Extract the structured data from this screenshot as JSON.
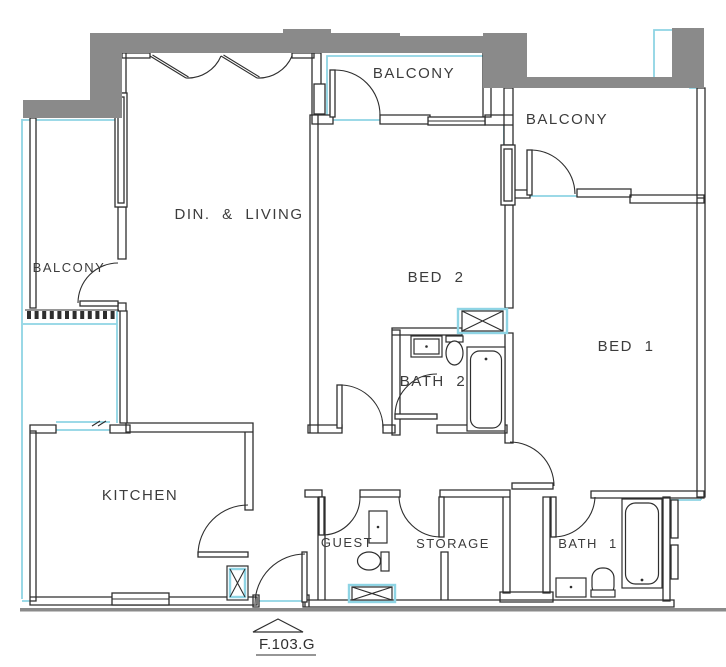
{
  "plan": {
    "unit_label": "F.103.G",
    "rooms": {
      "dining_living": "DIN. & LIVING",
      "balcony_left": "BALCONY",
      "balcony_top": "BALCONY",
      "balcony_right": "BALCONY",
      "bed_2": "BED 2",
      "bed_1": "BED 1",
      "bath_2": "BATH 2",
      "kitchen": "KITCHEN",
      "guest": "GUEST",
      "storage": "STORAGE",
      "bath_1": "BATH 1"
    },
    "colors": {
      "wall_gray": "#8a8a8a",
      "line_black": "#2e2e2e",
      "highlight_cyan": "#8ed4e4",
      "background": "#ffffff"
    }
  }
}
